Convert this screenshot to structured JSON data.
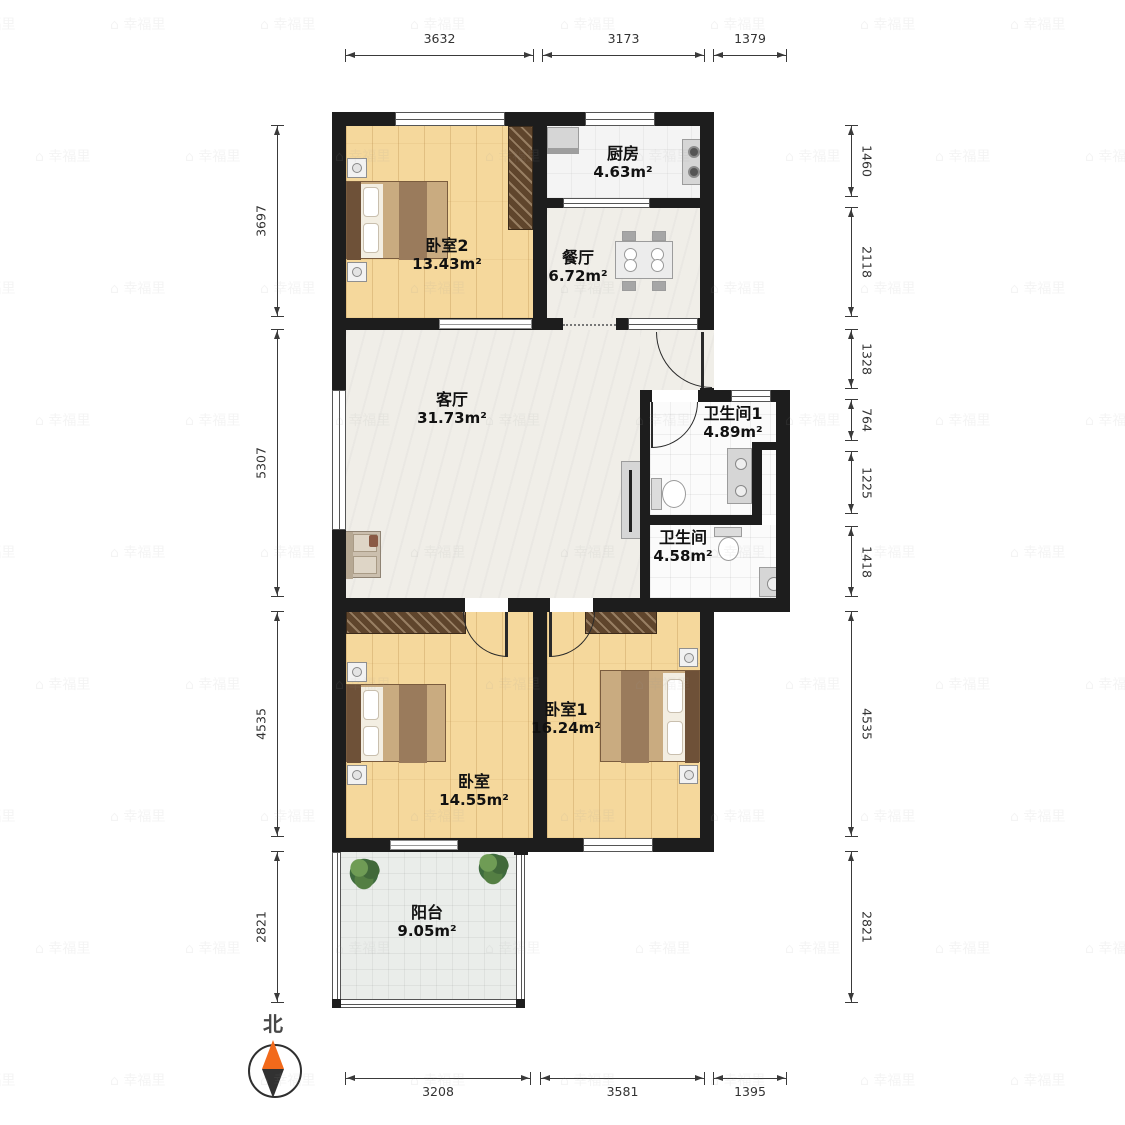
{
  "compass": {
    "north_label": "北"
  },
  "watermark": {
    "text": "幸福里"
  },
  "rooms": [
    {
      "id": "bedroom2",
      "name": "卧室2",
      "area": "13.43m²"
    },
    {
      "id": "kitchen",
      "name": "厨房",
      "area": "4.63m²"
    },
    {
      "id": "dining",
      "name": "餐厅",
      "area": "6.72m²"
    },
    {
      "id": "living",
      "name": "客厅",
      "area": "31.73m²"
    },
    {
      "id": "bathroom1",
      "name": "卫生间1",
      "area": "4.89m²"
    },
    {
      "id": "bathroom",
      "name": "卫生间",
      "area": "4.58m²"
    },
    {
      "id": "bedroom1",
      "name": "卧室1",
      "area": "16.24m²"
    },
    {
      "id": "bedroom",
      "name": "卧室",
      "area": "14.55m²"
    },
    {
      "id": "balcony",
      "name": "阳台",
      "area": "9.05m²"
    }
  ],
  "dimensions": {
    "top": [
      "3632",
      "3173",
      "1379"
    ],
    "bottom": [
      "3208",
      "3581",
      "1395"
    ],
    "left": [
      "3697",
      "5307",
      "4535",
      "2821"
    ],
    "right": [
      "1460",
      "2118",
      "1328",
      "764",
      "1225",
      "1418",
      "4535",
      "2821"
    ]
  },
  "furniture": [
    "double-bed",
    "wardrobe",
    "nightstand",
    "kitchen-counter",
    "stove",
    "dining-table",
    "armchair-sofa",
    "tv-stand",
    "toilet",
    "double-sink-vanity",
    "washing-machine",
    "plant"
  ],
  "colors": {
    "wall": "#1d1d1d",
    "wood_floor": "#f5d89c",
    "marble_floor": "#f0eee8",
    "wardrobe": "#5f452c",
    "compass_north": "#f26a1b"
  }
}
